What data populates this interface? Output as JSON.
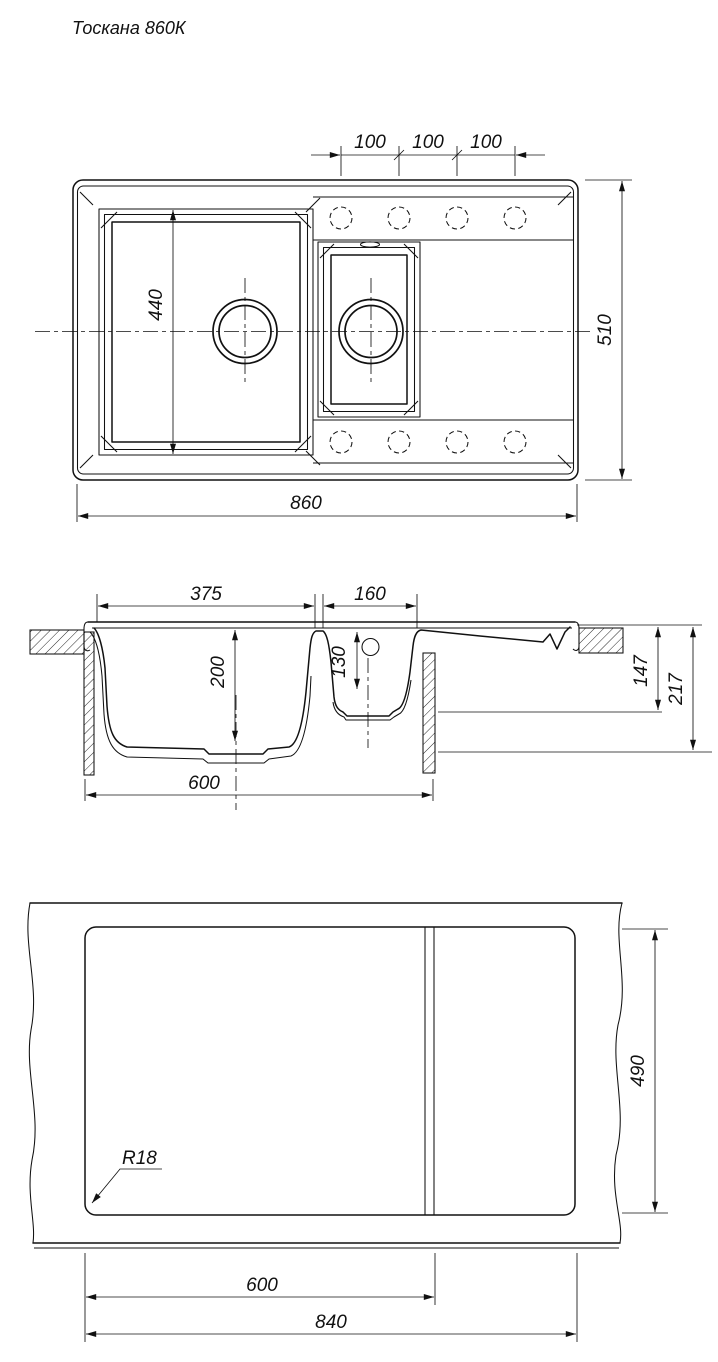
{
  "title": "Тоскана 860К",
  "top": {
    "hole_spacing_1": "100",
    "hole_spacing_2": "100",
    "hole_spacing_3": "100",
    "bowl_length": "440",
    "overall_depth": "510",
    "overall_width": "860"
  },
  "section": {
    "main_bowl_width": "375",
    "small_bowl_width": "160",
    "main_bowl_depth": "200",
    "small_bowl_depth": "130",
    "rim_to_base": "147",
    "overall_height": "217",
    "cabinet_width": "600"
  },
  "cutout": {
    "corner_radius": "R18",
    "cutout_depth": "490",
    "divider_offset": "600",
    "cutout_width": "840"
  }
}
